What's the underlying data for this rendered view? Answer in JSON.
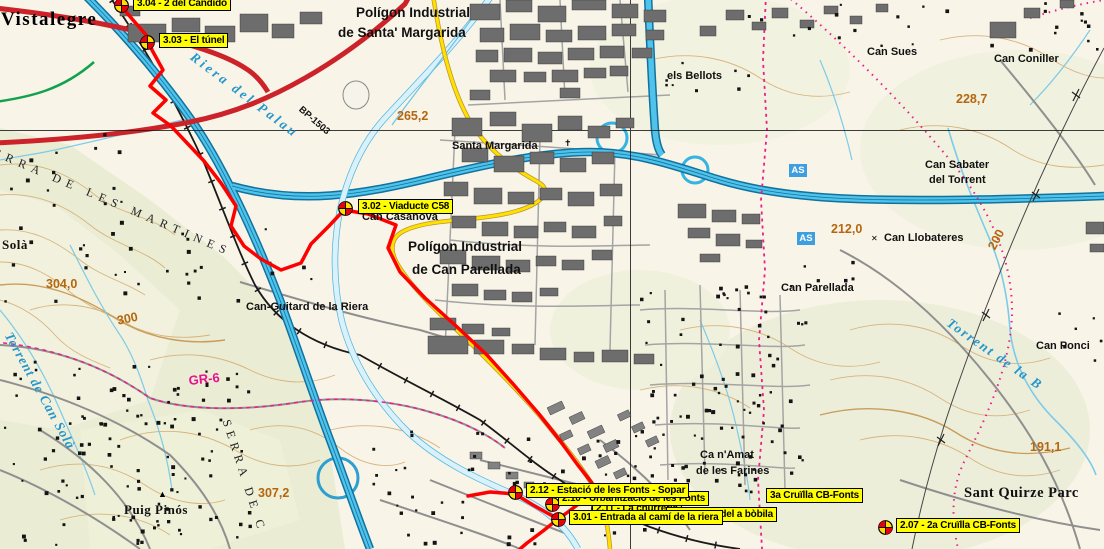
{
  "map": {
    "colors": {
      "waypoint_bg": "#ffff00",
      "route_red": "#ff0000",
      "road_red": "#cc2229",
      "motorway_blue": "#35b3e2",
      "road_yellow": "#ffe000",
      "road_green": "#12a14f",
      "boundary_magenta": "#ec1e8c",
      "elevation_brown": "#b5660f",
      "water_blue": "#2596cc",
      "shield_blue": "#3d9fe0"
    },
    "labels": [
      {
        "t": "Vistalegre",
        "x": 1,
        "y": 10,
        "s": "town"
      },
      {
        "t": "Polígon Industrial",
        "x": 356,
        "y": 6,
        "s": "place-lg"
      },
      {
        "t": "de Santa' Margarida",
        "x": 338,
        "y": 26,
        "s": "place-lg"
      },
      {
        "t": "Polígon Industrial",
        "x": 408,
        "y": 240,
        "s": "place-lg"
      },
      {
        "t": "de Can Parellada",
        "x": 412,
        "y": 263,
        "s": "place-lg"
      },
      {
        "t": "els Bellots",
        "x": 667,
        "y": 71,
        "s": "place"
      },
      {
        "t": "Can Sues",
        "x": 867,
        "y": 47,
        "s": "place"
      },
      {
        "t": "Can Coniller",
        "x": 994,
        "y": 54,
        "s": "place"
      },
      {
        "t": "Can Sabater",
        "x": 925,
        "y": 160,
        "s": "place"
      },
      {
        "t": "del Torrent",
        "x": 929,
        "y": 175,
        "s": "place"
      },
      {
        "t": "Santa Margarida",
        "x": 452,
        "y": 141,
        "s": "place"
      },
      {
        "t": "Can Llobateres",
        "x": 884,
        "y": 233,
        "s": "place"
      },
      {
        "t": "Can Parellada",
        "x": 781,
        "y": 283,
        "s": "place"
      },
      {
        "t": "Can Ponci",
        "x": 1036,
        "y": 341,
        "s": "place"
      },
      {
        "t": "Ca n'Amat",
        "x": 700,
        "y": 450,
        "s": "place"
      },
      {
        "t": "de les Farines",
        "x": 696,
        "y": 466,
        "s": "place"
      },
      {
        "t": "Can-Guitard de la Riera",
        "x": 246,
        "y": 302,
        "s": "place"
      },
      {
        "t": "Can Casanova",
        "x": 362,
        "y": 212,
        "s": "place"
      },
      {
        "t": "Sant Quirze Parc",
        "x": 964,
        "y": 486,
        "s": "town-sm"
      },
      {
        "t": "Puig Pinós",
        "x": 124,
        "y": 503,
        "s": "town-xs"
      },
      {
        "t": "Solà",
        "x": 2,
        "y": 238,
        "s": "town-xs"
      },
      {
        "t": "265,2",
        "x": 397,
        "y": 110,
        "s": "elev"
      },
      {
        "t": "304,0",
        "x": 46,
        "y": 278,
        "s": "elev"
      },
      {
        "t": "300",
        "x": 116,
        "y": 315,
        "s": "elev",
        "r": -12
      },
      {
        "t": "307,2",
        "x": 258,
        "y": 487,
        "s": "elev"
      },
      {
        "t": "228,7",
        "x": 956,
        "y": 93,
        "s": "elev"
      },
      {
        "t": "212,0",
        "x": 831,
        "y": 223,
        "s": "elev"
      },
      {
        "t": "200",
        "x": 986,
        "y": 246,
        "s": "elev",
        "r": -62
      },
      {
        "t": "191,1",
        "x": 1030,
        "y": 441,
        "s": "elev"
      },
      {
        "t": "GR-6",
        "x": 188,
        "y": 374,
        "s": "gr",
        "r": -6
      },
      {
        "t": "BP-1503",
        "x": 303,
        "y": 105,
        "s": "roadlbl",
        "r": 41
      },
      {
        "t": "Riera del Palau",
        "x": 196,
        "y": 50,
        "s": "water",
        "r": 37,
        "ls": 3
      },
      {
        "t": "Torrent de Can Solà",
        "x": 14,
        "y": 330,
        "s": "water",
        "r": 61,
        "ls": 1
      },
      {
        "t": "Torrent de la B",
        "x": 952,
        "y": 316,
        "s": "water",
        "r": 35,
        "ls": 2
      },
      {
        "t": "ERRA DE LES MARTINES",
        "x": -4,
        "y": 146,
        "s": "spread",
        "r": 23,
        "ls": 6
      },
      {
        "t": "SERRA DE C",
        "x": 232,
        "y": 418,
        "s": "spread",
        "r": 72,
        "ls": 5
      },
      {
        "t": "▲",
        "x": 158,
        "y": 490,
        "s": "sym"
      },
      {
        "t": "✝",
        "x": 564,
        "y": 139,
        "s": "sym"
      },
      {
        "t": "✕",
        "x": 871,
        "y": 235,
        "s": "sym-sm"
      }
    ],
    "shields": [
      {
        "t": "AS",
        "x": 789,
        "y": 164
      },
      {
        "t": "AS",
        "x": 797,
        "y": 232
      }
    ],
    "waypoints": [
      {
        "id": "2.11",
        "t": "2.11 - La churreria",
        "box": [
          592,
          501
        ],
        "icon": [
          598,
          508
        ]
      },
      {
        "id": "2.10",
        "t": "2.10 - Urbanització de les Fonts",
        "box": [
          558,
          491
        ],
        "icon": [
          552,
          504
        ]
      },
      {
        "id": "2.08",
        "t": "3a Cruïlla CB-Fonts",
        "box": [
          766,
          488
        ],
        "icon": null
      },
      {
        "id": "2.09",
        "t": "2.09 - Font del a bòbila",
        "box": [
          666,
          507
        ],
        "icon": null
      },
      {
        "id": "3.01",
        "t": "3.01 - Entrada al camí de la riera",
        "box": [
          569,
          510
        ],
        "icon": [
          558,
          519
        ]
      },
      {
        "id": "2.12",
        "t": "2.12 - Estació de les Fonts - Sopar",
        "box": [
          526,
          483
        ],
        "icon": [
          515,
          492
        ]
      },
      {
        "id": "3.04",
        "t": "3.04 - 2 del Candido",
        "box": [
          133,
          -4
        ],
        "icon": [
          121,
          5
        ]
      },
      {
        "id": "3.03",
        "t": "3.03 - El túnel",
        "box": [
          159,
          33
        ],
        "icon": [
          147,
          42
        ]
      },
      {
        "id": "3.02",
        "t": "3.02 - Viaducte C58",
        "box": [
          358,
          199
        ],
        "icon": [
          345,
          208
        ]
      },
      {
        "id": "2.07",
        "t": "2.07 - 2a Cruïlla CB-Fonts",
        "box": [
          896,
          518
        ],
        "icon": [
          885,
          527
        ]
      }
    ]
  }
}
